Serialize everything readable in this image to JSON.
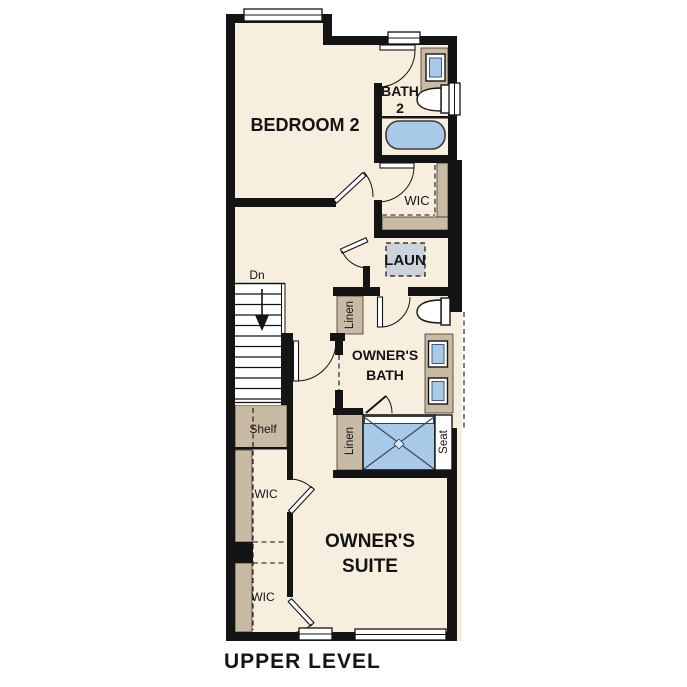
{
  "plan": {
    "title": "UPPER LEVEL",
    "labels": {
      "bedroom2": "BEDROOM 2",
      "bath2_line1": "BATH",
      "bath2_line2": "2",
      "wic_top": "WIC",
      "laundry": "LAUN",
      "linen_upper": "Linen",
      "linen_lower": "Linen",
      "owners_bath_line1": "OWNER'S",
      "owners_bath_line2": "BATH",
      "owners_suite_line1": "OWNER'S",
      "owners_suite_line2": "SUITE",
      "wic_left_upper": "WIC",
      "wic_left_lower": "WIC",
      "shelf": "Shelf",
      "seat": "Seat",
      "stairs_down": "Dn"
    },
    "colors": {
      "floor": "#f8eede",
      "wall": "#141414",
      "casework_tan": "#c9baa3",
      "fixture_blue": "#a9c9e9",
      "fixture_blue_stroke": "#3d5a78",
      "laundry_pad_gray": "#ccd3dc",
      "white": "#ffffff"
    }
  }
}
